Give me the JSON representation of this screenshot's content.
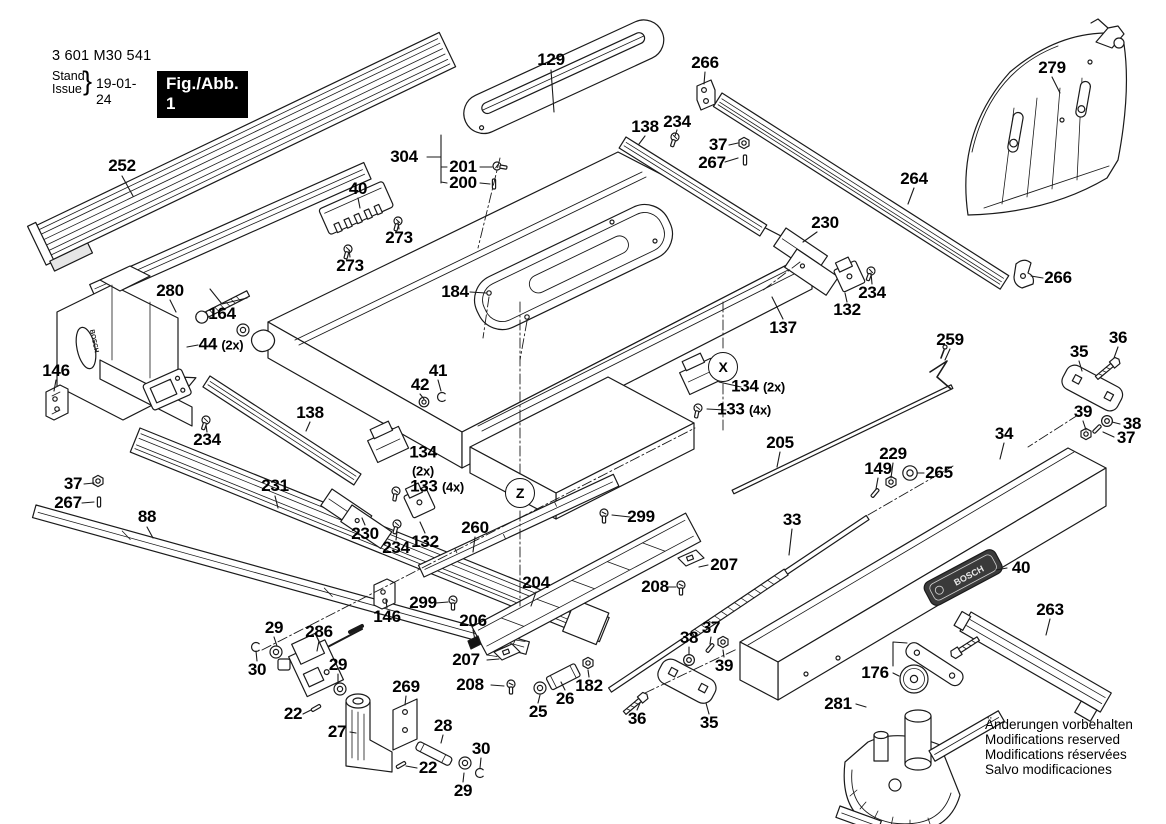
{
  "header": {
    "model_no": "3 601 M30 541",
    "stand_label": "Stand",
    "issue_label": "Issue",
    "brace": "}",
    "date": "19-01-24",
    "figure_label": "Fig./Abb. 1"
  },
  "brand": "BOSCH",
  "notices": [
    "Änderungen vorbehalten",
    "Modifications reserved",
    "Modifications réservées",
    "Salvo modificaciones"
  ],
  "diagram_colors": {
    "line": "#1a1a1a",
    "fill": "#ffffff",
    "shade": "#d9d9d9",
    "plate_dark": "#3a3a3a"
  },
  "callouts": [
    {
      "t": "252",
      "x": 122,
      "y": 166
    },
    {
      "t": "129",
      "x": 551,
      "y": 60
    },
    {
      "t": "266",
      "x": 705,
      "y": 63
    },
    {
      "t": "279",
      "x": 1052,
      "y": 68
    },
    {
      "t": "138",
      "x": 645,
      "y": 127
    },
    {
      "t": "234",
      "x": 677,
      "y": 122
    },
    {
      "t": "37",
      "x": 718,
      "y": 145
    },
    {
      "t": "267",
      "x": 712,
      "y": 163
    },
    {
      "t": "264",
      "x": 914,
      "y": 179
    },
    {
      "t": "304",
      "x": 404,
      "y": 157
    },
    {
      "t": "201",
      "x": 463,
      "y": 167
    },
    {
      "t": "200",
      "x": 463,
      "y": 183
    },
    {
      "t": "40",
      "x": 358,
      "y": 189
    },
    {
      "t": "273",
      "x": 399,
      "y": 238
    },
    {
      "t": "273",
      "x": 350,
      "y": 266
    },
    {
      "t": "230",
      "x": 825,
      "y": 223
    },
    {
      "t": "280",
      "x": 170,
      "y": 291
    },
    {
      "t": "164",
      "x": 222,
      "y": 314
    },
    {
      "t": "184",
      "x": 455,
      "y": 292
    },
    {
      "t": "266",
      "x": 1058,
      "y": 278
    },
    {
      "t": "234",
      "x": 872,
      "y": 293
    },
    {
      "t": "132",
      "x": 847,
      "y": 310
    },
    {
      "t": "137",
      "x": 783,
      "y": 328
    },
    {
      "t": "44 (2x)",
      "x": 221,
      "y": 345
    },
    {
      "t": "X",
      "x": 723,
      "y": 367,
      "kind": "circled"
    },
    {
      "t": "134 (2x)",
      "x": 758,
      "y": 387
    },
    {
      "t": "133 (4x)",
      "x": 744,
      "y": 410
    },
    {
      "t": "146",
      "x": 56,
      "y": 371
    },
    {
      "t": "259",
      "x": 950,
      "y": 340
    },
    {
      "t": "36",
      "x": 1118,
      "y": 338
    },
    {
      "t": "35",
      "x": 1079,
      "y": 352
    },
    {
      "t": "41",
      "x": 438,
      "y": 371
    },
    {
      "t": "42",
      "x": 420,
      "y": 385
    },
    {
      "t": "138",
      "x": 310,
      "y": 413
    },
    {
      "t": "234",
      "x": 207,
      "y": 440
    },
    {
      "t": "39",
      "x": 1083,
      "y": 412
    },
    {
      "t": "38",
      "x": 1132,
      "y": 424
    },
    {
      "t": "37",
      "x": 1126,
      "y": 438
    },
    {
      "t": "205",
      "x": 780,
      "y": 443
    },
    {
      "t": "34",
      "x": 1004,
      "y": 434
    },
    {
      "t": "229",
      "x": 893,
      "y": 454
    },
    {
      "t": "149",
      "x": 878,
      "y": 469
    },
    {
      "t": "265",
      "x": 939,
      "y": 473
    },
    {
      "t": "134\n(2x)",
      "x": 423,
      "y": 462
    },
    {
      "t": "133 (4x)",
      "x": 437,
      "y": 487
    },
    {
      "t": "231",
      "x": 275,
      "y": 486
    },
    {
      "t": "37",
      "x": 73,
      "y": 484
    },
    {
      "t": "267",
      "x": 68,
      "y": 503
    },
    {
      "t": "88",
      "x": 147,
      "y": 517
    },
    {
      "t": "230",
      "x": 365,
      "y": 534
    },
    {
      "t": "234",
      "x": 396,
      "y": 548
    },
    {
      "t": "132",
      "x": 425,
      "y": 542
    },
    {
      "t": "260",
      "x": 475,
      "y": 528
    },
    {
      "t": "Z",
      "x": 520,
      "y": 493,
      "kind": "circled"
    },
    {
      "t": "299",
      "x": 641,
      "y": 517
    },
    {
      "t": "33",
      "x": 792,
      "y": 520
    },
    {
      "t": "299",
      "x": 423,
      "y": 603
    },
    {
      "t": "146",
      "x": 387,
      "y": 617
    },
    {
      "t": "204",
      "x": 536,
      "y": 583
    },
    {
      "t": "206",
      "x": 473,
      "y": 621
    },
    {
      "t": "207",
      "x": 466,
      "y": 660
    },
    {
      "t": "208",
      "x": 470,
      "y": 685
    },
    {
      "t": "207",
      "x": 724,
      "y": 565
    },
    {
      "t": "208",
      "x": 655,
      "y": 587
    },
    {
      "t": "40",
      "x": 1021,
      "y": 568
    },
    {
      "t": "263",
      "x": 1050,
      "y": 610
    },
    {
      "t": "29",
      "x": 274,
      "y": 628
    },
    {
      "t": "286",
      "x": 319,
      "y": 632
    },
    {
      "t": "30",
      "x": 257,
      "y": 670
    },
    {
      "t": "29",
      "x": 338,
      "y": 665
    },
    {
      "t": "22",
      "x": 293,
      "y": 714
    },
    {
      "t": "27",
      "x": 337,
      "y": 732
    },
    {
      "t": "269",
      "x": 406,
      "y": 687
    },
    {
      "t": "28",
      "x": 443,
      "y": 726
    },
    {
      "t": "22",
      "x": 428,
      "y": 768
    },
    {
      "t": "30",
      "x": 481,
      "y": 749
    },
    {
      "t": "29",
      "x": 463,
      "y": 791
    },
    {
      "t": "25",
      "x": 538,
      "y": 712
    },
    {
      "t": "26",
      "x": 565,
      "y": 699
    },
    {
      "t": "182",
      "x": 589,
      "y": 686
    },
    {
      "t": "38",
      "x": 689,
      "y": 638
    },
    {
      "t": "37",
      "x": 711,
      "y": 628
    },
    {
      "t": "39",
      "x": 724,
      "y": 666
    },
    {
      "t": "36",
      "x": 637,
      "y": 719
    },
    {
      "t": "35",
      "x": 709,
      "y": 723
    },
    {
      "t": "176",
      "x": 875,
      "y": 673
    },
    {
      "t": "281",
      "x": 838,
      "y": 704
    }
  ]
}
